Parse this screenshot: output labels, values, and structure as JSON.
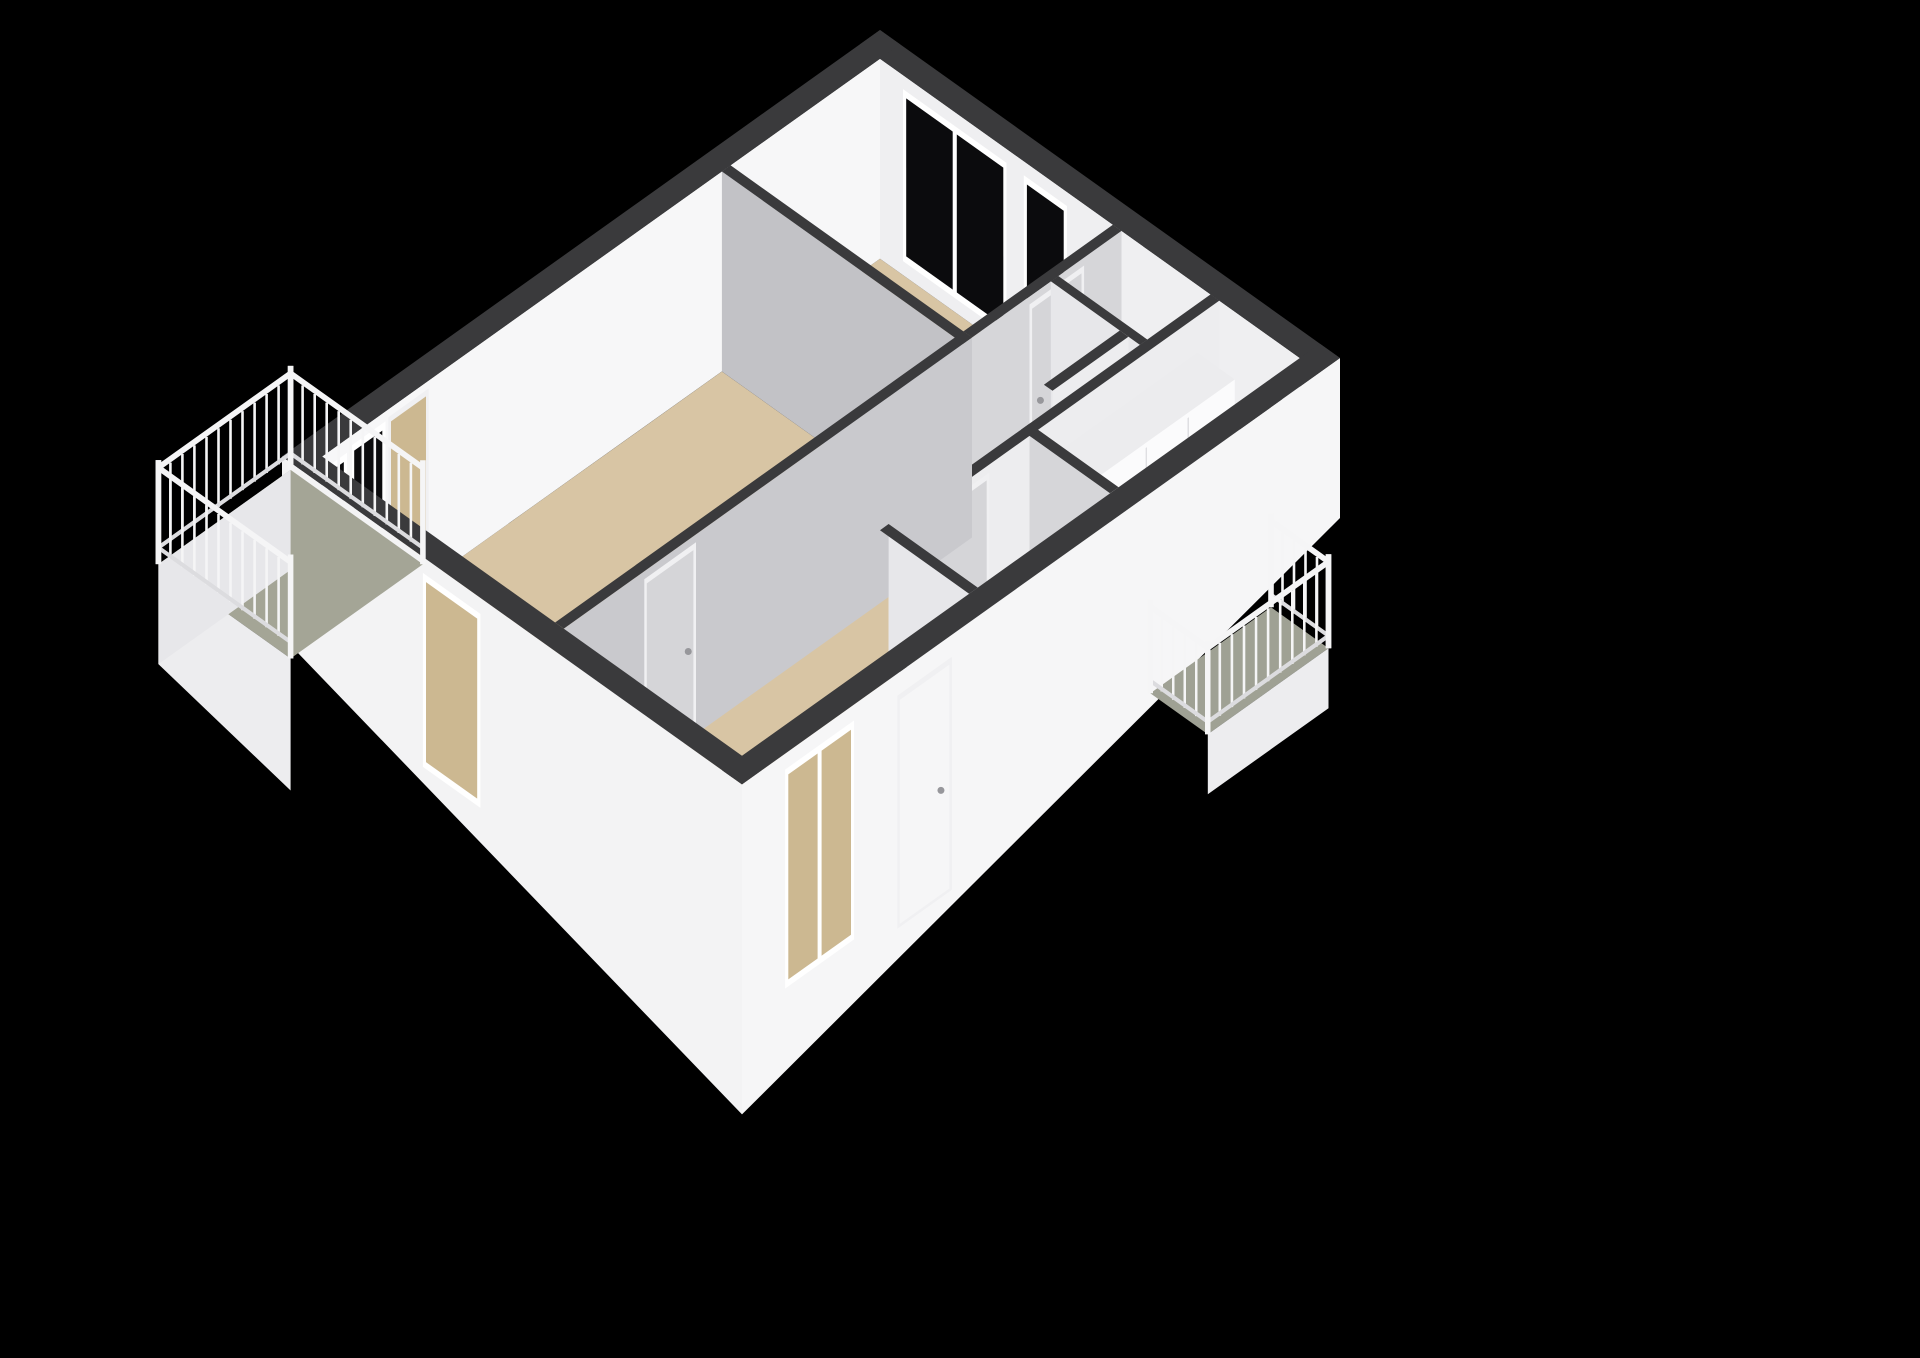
{
  "scene": {
    "canvas": {
      "w": 1920,
      "h": 1358,
      "bg": "#000000"
    },
    "projection": {
      "ox": 880,
      "oy": 30,
      "ex": 57.5,
      "ey": 41
    },
    "colors": {
      "band": "#3a3a3c",
      "beige": "#d8c5a4",
      "beigeDark": "#ccb891",
      "blue": "#cfdbe4",
      "blueGray": "#d8dee3",
      "green": "#a4a596",
      "greenDark": "#9fa194",
      "whiteFace": "#f7f7f8",
      "nFace": "#efeff1",
      "grayFace": "#c2c2c6",
      "grayFace2": "#c9c9cd",
      "midFace": "#d6d6d9",
      "softFace": "#e7e7ea",
      "paleFace": "#ededef",
      "skirt": "#f3f3f4",
      "skirtE": "#f6f6f7",
      "glass": "#0b0b0d",
      "frame": "#ffffff",
      "door": "#d5d5d8",
      "doorFrame": "#f0f0f2",
      "handle": "#97979b",
      "cabFront": "#fbfbfc",
      "cabSide": "#e3e3e6",
      "cabTop": "#ececee",
      "oven": "#17171a",
      "ovenHandle": "#77777b",
      "rail": "#f5f5f6",
      "railShade": "#dcdcdf",
      "pipe": "#1a1a1c",
      "pipeTop": "#303032",
      "fixture": "#f1f1f3",
      "fixtureEdge": "#c6c6ca",
      "seam": "#d8d8db",
      "meter1": "#232325",
      "meter2": "#2b2b2d",
      "meterDot": "#a87040",
      "bars": "#c5cacc"
    },
    "rooms": [
      {
        "name": "bedroom",
        "floor": "beige"
      },
      {
        "name": "living-room",
        "floor": "beige"
      },
      {
        "name": "hallway",
        "floor": "beige"
      },
      {
        "name": "entry",
        "floor": "beige"
      },
      {
        "name": "kitchen",
        "floor": "blue"
      },
      {
        "name": "bathroom",
        "floor": "blue"
      },
      {
        "name": "toilet",
        "floor": "blueGray"
      },
      {
        "name": "balcony-southwest",
        "floor": "green"
      },
      {
        "name": "balcony-east",
        "floor": "greenDark"
      }
    ],
    "elements": [
      {
        "type": "rect",
        "rect": [
          0.35,
          0.35,
          4.4,
          2.95
        ],
        "dy": 200,
        "fill": "beige",
        "name": "bedroom-floor"
      },
      {
        "type": "rect",
        "rect": [
          0.35,
          3.1,
          4.4,
          10.05
        ],
        "dy": 200,
        "fill": "beige",
        "name": "living-room-floor"
      },
      {
        "type": "rect",
        "rect": [
          4.4,
          0.35,
          6.25,
          10.05
        ],
        "dy": 200,
        "fill": "beige",
        "name": "hallway-floor"
      },
      {
        "type": "rect",
        "rect": [
          6.25,
          6.1,
          7.65,
          10.05
        ],
        "dy": 200,
        "fill": "beige",
        "name": "entry-floor"
      },
      {
        "type": "rect",
        "rect": [
          6.25,
          0.35,
          7.65,
          3.5
        ],
        "dy": 200,
        "fill": "blue",
        "name": "kitchen-floor"
      },
      {
        "type": "rect",
        "rect": [
          6.25,
          3.65,
          7.65,
          5.95
        ],
        "dy": 200,
        "fill": "blue",
        "name": "bathroom-floor"
      },
      {
        "type": "rect",
        "rect": [
          4.55,
          1.58,
          5.75,
          2.9
        ],
        "dy": 200,
        "fill": "blueGray",
        "name": "toilet-floor"
      },
      {
        "type": "face",
        "line": [
          0.35,
          0.35,
          7.65,
          0.35
        ],
        "dys": [
          0,
          0,
          200,
          200
        ],
        "fill": "nFace",
        "name": "north-wall-inner-face"
      },
      {
        "type": "window",
        "line": [
          0.75,
          0.35,
          2.55,
          0.35
        ],
        "top": 14,
        "bot": 186,
        "mullions": [
          0.5
        ],
        "name": "bedroom-window-large"
      },
      {
        "type": "window",
        "line": [
          2.85,
          0.35,
          3.6,
          0.35
        ],
        "top": 14,
        "bot": 186,
        "name": "bedroom-window-small"
      },
      {
        "type": "rect",
        "rect": [
          0,
          0,
          8,
          0.35
        ],
        "dy": 0,
        "fill": "band",
        "name": "north-wall-top"
      },
      {
        "type": "face",
        "line": [
          0.35,
          0.35,
          0.35,
          10.05
        ],
        "dys": [
          0,
          0,
          200,
          200
        ],
        "fill": "whiteFace",
        "name": "west-wall-inner-face"
      },
      {
        "type": "door",
        "line": [
          0.35,
          8.2,
          0.35,
          8.9
        ],
        "top": 8,
        "bot": 200,
        "leaf": "beigeDark",
        "name": "balcony-doorway"
      },
      {
        "type": "window",
        "line": [
          0.35,
          8.95,
          0.35,
          9.55
        ],
        "top": 10,
        "bot": 184,
        "name": "balcony-bay-window"
      },
      {
        "type": "window",
        "line": [
          0.35,
          9.62,
          0.35,
          10.0
        ],
        "top": 14,
        "bot": 186,
        "name": "living-west-window"
      },
      {
        "type": "face",
        "line": [
          4.55,
          0.35,
          4.55,
          2.95
        ],
        "dys": [
          0,
          0,
          200,
          200
        ],
        "fill": "midFace",
        "name": "bedroom-east-wall-face"
      },
      {
        "type": "door",
        "line": [
          4.55,
          1.0,
          4.55,
          1.95
        ],
        "top": 8,
        "bot": 200,
        "handle": 0.8,
        "name": "bedroom-door"
      },
      {
        "type": "rect",
        "rect": [
          4.4,
          0.35,
          4.55,
          2.95
        ],
        "dy": 0,
        "fill": "band",
        "name": "bedroom-east-wall-top"
      },
      {
        "type": "face",
        "line": [
          4.55,
          1.58,
          6.1,
          1.58
        ],
        "dys": [
          0,
          0,
          200,
          200
        ],
        "fill": "softFace",
        "name": "toilet-north-wall-face"
      },
      {
        "type": "rect",
        "rect": [
          4.55,
          1.45,
          6.1,
          1.58
        ],
        "dy": 0,
        "fill": "band",
        "name": "toilet-north-wall-top"
      },
      {
        "type": "face",
        "line": [
          5.9,
          1.58,
          5.9,
          2.9
        ],
        "dys": [
          0,
          0,
          200,
          200
        ],
        "fill": "paleFace",
        "name": "toilet-east-wall-face"
      },
      {
        "type": "rect",
        "rect": [
          5.75,
          1.58,
          5.9,
          2.9
        ],
        "dy": 0,
        "fill": "band",
        "name": "toilet-east-wall-top"
      },
      {
        "type": "face",
        "line": [
          4.95,
          1.66,
          5.38,
          1.66
        ],
        "dys": [
          150,
          150,
          192,
          192
        ],
        "fill": "fixture",
        "name": "toilet-tank"
      },
      {
        "type": "ellipse",
        "at": [
          5.16,
          1.98
        ],
        "dy": 190,
        "rx": 11,
        "ry": 6.5,
        "fill": "fixture",
        "stroke": "fixtureEdge",
        "name": "toilet-bowl"
      },
      {
        "type": "face",
        "line": [
          0.35,
          3.1,
          4.55,
          3.1
        ],
        "dys": [
          0,
          0,
          200,
          200
        ],
        "fill": "grayFace",
        "name": "bedroom-living-divider-face"
      },
      {
        "type": "rect",
        "rect": [
          0.35,
          2.95,
          4.55,
          3.1
        ],
        "dy": 0,
        "fill": "band",
        "name": "bedroom-living-divider-top"
      },
      {
        "type": "face",
        "line": [
          6.25,
          0.35,
          6.25,
          6.1
        ],
        "dys": [
          0,
          0,
          200,
          200
        ],
        "fill": "paleFace",
        "name": "kitchen-west-wall-face"
      },
      {
        "type": "door",
        "line": [
          6.25,
          4.35,
          6.25,
          5.25
        ],
        "top": 8,
        "bot": 200,
        "handle": 0.85,
        "name": "bathroom-door"
      },
      {
        "type": "rect",
        "rect": [
          6.1,
          0.35,
          6.25,
          6.1
        ],
        "dy": 0,
        "fill": "band",
        "name": "kitchen-west-wall-top"
      },
      {
        "type": "rect",
        "rect": [
          6.27,
          0.75,
          6.92,
          3.25
        ],
        "dy": 35,
        "fill": "cabTop",
        "name": "kitchen-cabinets-top"
      },
      {
        "type": "face",
        "line": [
          6.92,
          0.75,
          6.92,
          3.25
        ],
        "dys": [
          35,
          35,
          200,
          200
        ],
        "fill": "cabFront",
        "name": "kitchen-cabinets-front"
      },
      {
        "type": "face",
        "line": [
          6.92,
          1.55,
          6.92,
          1.57
        ],
        "dys": [
          40,
          40,
          198,
          198
        ],
        "fill": "seam",
        "name": "kitchen-cabinet-seam"
      },
      {
        "type": "face",
        "line": [
          6.92,
          2.28,
          6.92,
          2.3
        ],
        "dys": [
          40,
          40,
          198,
          198
        ],
        "fill": "seam",
        "name": "kitchen-cabinet-seam"
      },
      {
        "type": "face",
        "line": [
          6.92,
          2.38,
          6.92,
          2.98
        ],
        "dys": [
          78,
          78,
          168,
          168
        ],
        "fill": "oven",
        "name": "kitchen-oven"
      },
      {
        "type": "face",
        "line": [
          6.92,
          2.4,
          6.92,
          2.96
        ],
        "dys": [
          86,
          86,
          91,
          91
        ],
        "fill": "ovenHandle",
        "name": "kitchen-oven-handle"
      },
      {
        "type": "face",
        "line": [
          6.27,
          3.25,
          6.92,
          3.25
        ],
        "dys": [
          35,
          35,
          200,
          200
        ],
        "fill": "cabSide",
        "name": "kitchen-cabinets-side"
      },
      {
        "type": "face",
        "line": [
          6.25,
          3.65,
          7.65,
          3.65
        ],
        "dys": [
          0,
          0,
          200,
          200
        ],
        "fill": "midFace",
        "name": "kitchen-bath-divider-face"
      },
      {
        "type": "rect",
        "rect": [
          6.1,
          3.5,
          7.65,
          3.65
        ],
        "dy": 0,
        "fill": "band",
        "name": "kitchen-bath-divider-top"
      },
      {
        "type": "face",
        "line": [
          4.55,
          2.95,
          4.55,
          10.05
        ],
        "dys": [
          0,
          0,
          200,
          200
        ],
        "fill": "grayFace2",
        "name": "living-hall-divider-face"
      },
      {
        "type": "door",
        "line": [
          4.55,
          7.75,
          4.55,
          8.65
        ],
        "top": 8,
        "bot": 200,
        "handle": 0.15,
        "name": "living-room-door"
      },
      {
        "type": "rect",
        "rect": [
          4.4,
          2.95,
          4.55,
          10.05
        ],
        "dy": 0,
        "fill": "band",
        "name": "living-hall-divider-top"
      },
      {
        "type": "face",
        "line": [
          6.25,
          6.1,
          7.65,
          6.1
        ],
        "dys": [
          0,
          0,
          200,
          200
        ],
        "fill": "softFace",
        "name": "bath-south-wall-face"
      },
      {
        "type": "face",
        "line": [
          6.45,
          6.1,
          6.64,
          6.1
        ],
        "dys": [
          118,
          118,
          178,
          178
        ],
        "fill": "meter1",
        "name": "meter-box"
      },
      {
        "type": "face",
        "line": [
          6.68,
          6.1,
          6.86,
          6.1
        ],
        "dys": [
          126,
          126,
          178,
          178
        ],
        "fill": "meter2",
        "name": "meter-box"
      },
      {
        "type": "ellipse",
        "at": [
          6.56,
          6.1
        ],
        "dy": 112,
        "rx": 3,
        "ry": 2,
        "fill": "meterDot",
        "name": "meter-indicator"
      },
      {
        "type": "rect",
        "rect": [
          6.1,
          5.95,
          7.65,
          6.1
        ],
        "dy": 0,
        "fill": "band",
        "name": "bath-south-wall-top"
      },
      {
        "type": "window",
        "line": [
          7.65,
          0.6,
          7.65,
          1.45
        ],
        "top": 12,
        "bot": 188,
        "bars": 4,
        "name": "kitchen-balcony-window"
      },
      {
        "type": "door",
        "line": [
          7.65,
          1.6,
          7.65,
          2.55
        ],
        "top": 6,
        "bot": 200,
        "handle": 0.15,
        "leaf": "door",
        "name": "kitchen-balcony-door"
      },
      {
        "type": "pipe",
        "at": [
          6.8,
          9.45
        ],
        "w": 9,
        "dyTop": 62,
        "dyBot": 200,
        "name": "stove-pipe"
      },
      {
        "type": "face",
        "line": [
          0,
          10.4,
          8,
          10.4
        ],
        "dys": [
          0,
          0,
          330,
          180
        ],
        "fill": "skirt",
        "name": "south-exterior-wall"
      },
      {
        "type": "window",
        "line": [
          2.45,
          10.4,
          3.45,
          10.4
        ],
        "top": 16,
        "bot": 210,
        "inner": "beigeDark",
        "name": "south-window"
      },
      {
        "type": "rect",
        "rect": [
          0,
          10.05,
          8,
          10.4
        ],
        "dy": 0,
        "fill": "band",
        "name": "south-wall-top"
      },
      {
        "type": "face",
        "line": [
          8,
          0,
          8,
          10.4
        ],
        "dys": [
          0,
          0,
          330,
          160
        ],
        "fill": "skirtE",
        "name": "east-exterior-wall"
      },
      {
        "type": "door",
        "line": [
          8,
          6.75,
          8,
          7.7
        ],
        "top": 22,
        "bot": 255,
        "leaf": "skirtE",
        "handle": 0.2,
        "name": "front-door"
      },
      {
        "type": "window",
        "line": [
          8,
          8.45,
          8,
          9.65
        ],
        "top": 16,
        "bot": 235,
        "inner": "beigeDark",
        "mullions": [
          0.5
        ],
        "name": "east-tall-window"
      },
      {
        "type": "rect",
        "rect": [
          7.65,
          0,
          8,
          10.4
        ],
        "dy": 0,
        "fill": "band",
        "name": "east-wall-top"
      },
      {
        "type": "rect",
        "rect": [
          0,
          0,
          0.35,
          10.4
        ],
        "dy": 0,
        "fill": "band",
        "name": "west-wall-top"
      },
      {
        "type": "rect",
        "rect": [
          -2.2,
          8.05,
          0.1,
          10.35
        ],
        "dy": 200,
        "fill": "green",
        "name": "balcony-floor"
      },
      {
        "type": "face",
        "line": [
          -2.2,
          10.35,
          0.1,
          10.35
        ],
        "dys": [
          200,
          200,
          332,
          300
        ],
        "fill": "paleFace",
        "name": "balcony-skirt-south"
      },
      {
        "type": "face",
        "line": [
          -2.2,
          8.05,
          -2.2,
          10.35
        ],
        "dys": [
          200,
          200,
          300,
          300
        ],
        "fill": "softFace",
        "name": "balcony-skirt-west"
      },
      {
        "type": "railing",
        "line": [
          -2.2,
          8.05,
          0.1,
          8.05
        ],
        "topY": 100,
        "botY": 186,
        "name": "balcony-railing-north"
      },
      {
        "type": "railing",
        "line": [
          -2.2,
          8.05,
          -2.2,
          10.35
        ],
        "topY": 100,
        "botY": 186,
        "name": "balcony-railing-west"
      },
      {
        "type": "railing",
        "line": [
          -2.2,
          10.35,
          0.1,
          10.35
        ],
        "topY": 100,
        "botY": 186,
        "name": "balcony-railing-south"
      },
      {
        "type": "rect",
        "rect": [
          8.0,
          1.2,
          9.0,
          3.3
        ],
        "dy": 200,
        "fill": "greenDark",
        "name": "east-balcony-floor"
      },
      {
        "type": "face",
        "line": [
          9.0,
          1.2,
          9.0,
          3.3
        ],
        "dys": [
          200,
          200,
          260,
          260
        ],
        "fill": "paleFace",
        "name": "east-balcony-skirt"
      },
      {
        "type": "railing",
        "line": [
          8.0,
          1.2,
          9.0,
          1.2
        ],
        "topY": 110,
        "botY": 190,
        "name": "east-balcony-railing-north"
      },
      {
        "type": "railing",
        "line": [
          9.0,
          1.2,
          9.0,
          3.3
        ],
        "topY": 110,
        "botY": 190,
        "name": "east-balcony-railing-east"
      },
      {
        "type": "railing",
        "line": [
          8.0,
          3.3,
          9.0,
          3.3
        ],
        "topY": 110,
        "botY": 190,
        "name": "east-balcony-railing-south"
      }
    ]
  }
}
